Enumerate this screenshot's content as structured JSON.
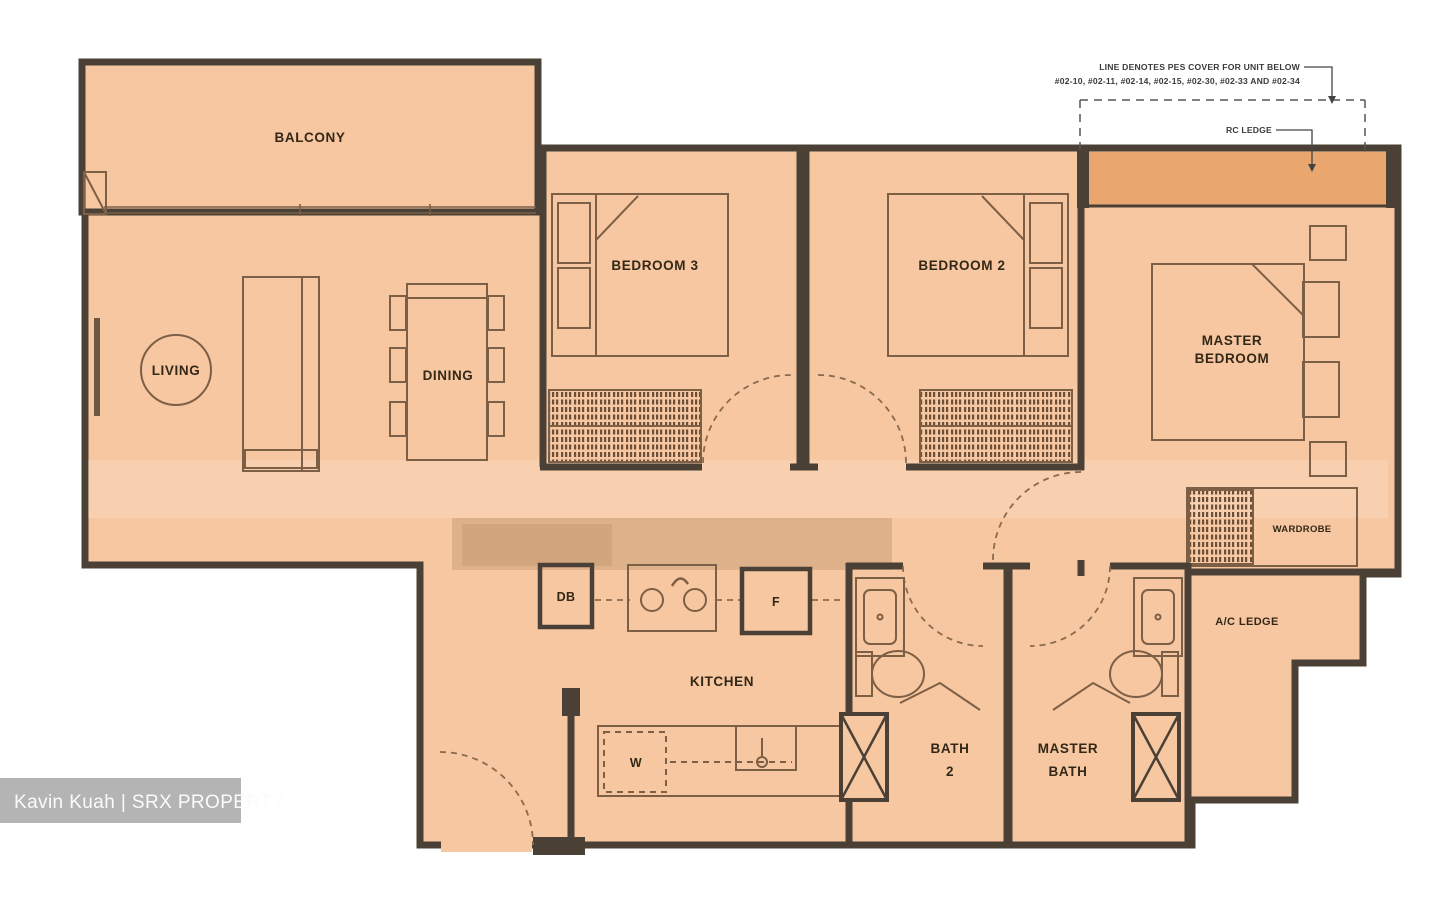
{
  "plan": {
    "rooms": {
      "balcony": "BALCONY",
      "living": "LIVING",
      "dining": "DINING",
      "bedroom3": "BEDROOM 3",
      "bedroom2": "BEDROOM 2",
      "master_bedroom_l1": "MASTER",
      "master_bedroom_l2": "BEDROOM",
      "kitchen": "KITCHEN",
      "bath2_l1": "BATH",
      "bath2_l2": "2",
      "master_bath_l1": "MASTER",
      "master_bath_l2": "BATH",
      "wardrobe": "WARDROBE",
      "ac_ledge": "A/C LEDGE"
    },
    "fixtures": {
      "db": "DB",
      "fridge": "F",
      "washer": "W"
    },
    "annotations": {
      "pes_line1": "LINE DENOTES PES COVER FOR UNIT BELOW",
      "pes_line2": "#02-10, #02-11, #02-14, #02-15, #02-30, #02-33 AND #02-34",
      "rc_ledge": "RC LEDGE"
    },
    "watermark": "Kavin Kuah | SRX PROPERTY",
    "colors": {
      "unit_fill": "#f7c7a1",
      "ledge_fill": "#e9a76f",
      "wall": "#4a4036",
      "furniture_line": "#7d5f45",
      "dashed_line": "#8a6b50",
      "counter_band": "#c99f78",
      "watermark_bg": "#b4b4b4",
      "watermark_text": "#fbfbfb"
    }
  }
}
